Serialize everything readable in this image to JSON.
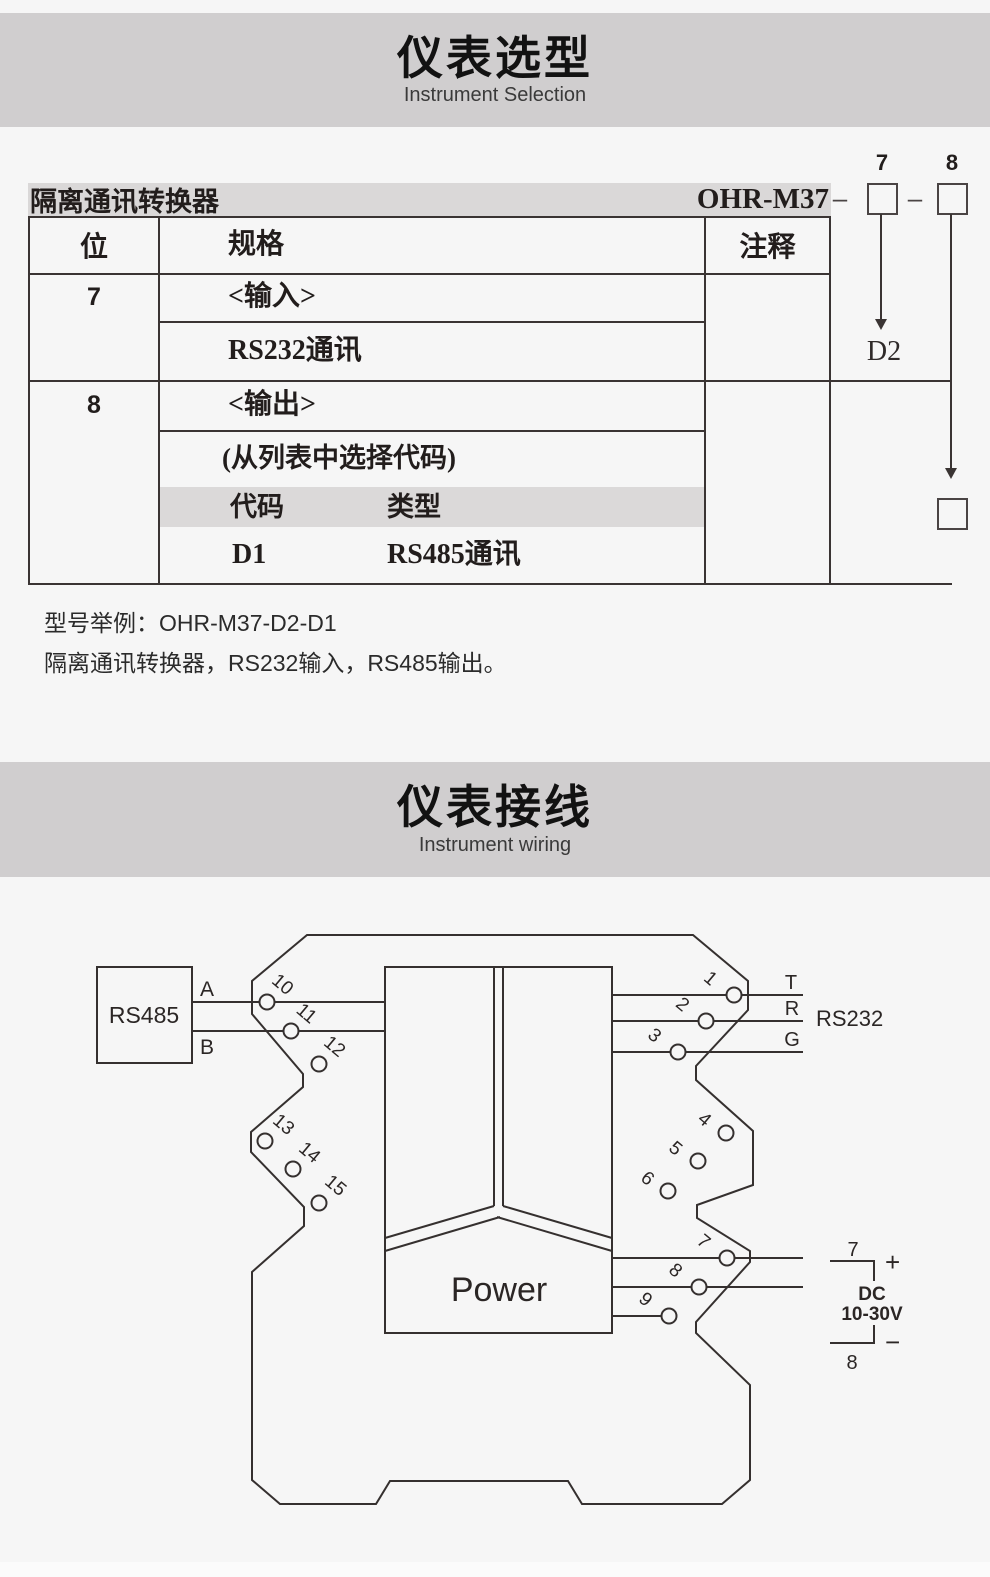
{
  "header1": {
    "title": "仪表选型",
    "subtitle": "Instrument Selection"
  },
  "header2": {
    "title": "仪表接线",
    "subtitle": "Instrument wiring"
  },
  "selection": {
    "product": "隔离通讯转换器",
    "model": "OHR-M37",
    "dash1": "–",
    "dash2": "–",
    "digit7": "7",
    "digit8": "8",
    "arrow7_value": "D2",
    "headers": {
      "position": "位",
      "spec": "规格",
      "note": "注释"
    },
    "row7": {
      "position": "7",
      "spec_title": "<输入>",
      "spec_value": "RS232通讯"
    },
    "row8": {
      "position": "8",
      "spec_title": "<输出>",
      "spec_hint": "(从列表中选择代码)",
      "code_header": "代码",
      "type_header": "类型",
      "entry_code": "D1",
      "entry_type": "RS485通讯"
    },
    "example_title": "型号举例：OHR-M37-D2-D1",
    "example_desc": "隔离通讯转换器，RS232输入，RS485输出。"
  },
  "wiring": {
    "rs485": "RS485",
    "line_a": "A",
    "line_b": "B",
    "rs232": "RS232",
    "line_t": "T",
    "line_r": "R",
    "line_g": "G",
    "power": "Power",
    "dc_top_terminal": "7",
    "dc_plus": "+",
    "dc_label": "DC",
    "dc_range": "10-30V",
    "dc_minus": "−",
    "dc_bottom_terminal": "8",
    "terminal_labels": [
      "1",
      "2",
      "3",
      "4",
      "5",
      "6",
      "7",
      "8",
      "9",
      "10",
      "11",
      "12",
      "13",
      "14",
      "15"
    ]
  },
  "colors": {
    "page_bg": "#f6f6f6",
    "section_band": "#d0cecf",
    "table_title_bar": "#dad8d8",
    "subheader_band": "#dbd9d9",
    "line": "#3a3433",
    "diagram_stroke": "#35302f"
  }
}
